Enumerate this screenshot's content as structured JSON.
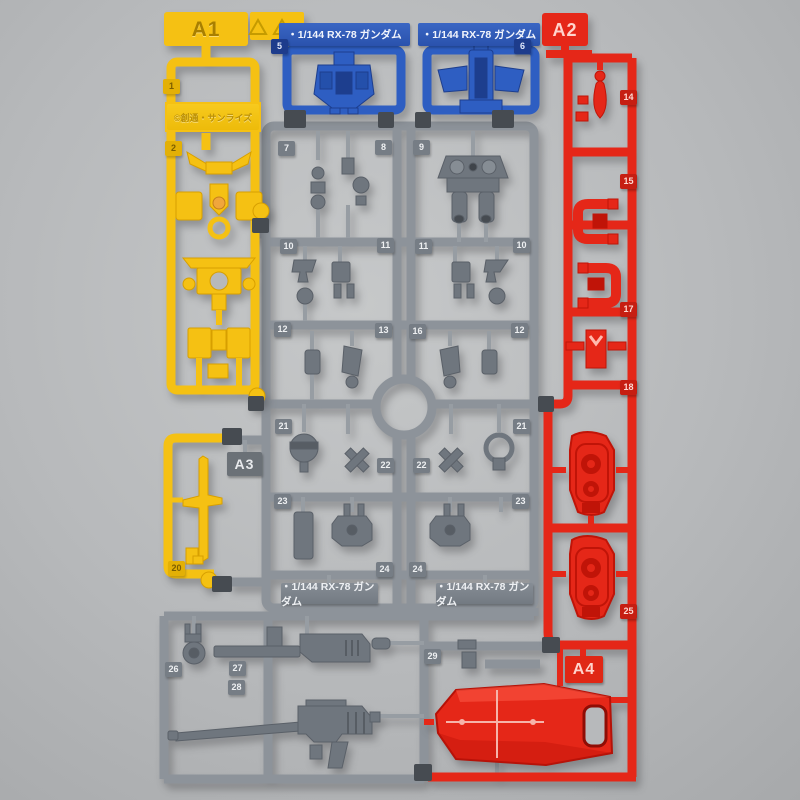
{
  "scene": {
    "subject": "Plastic model kit runner sprue photo — 1/144 RX-78 Gundam, multi-color molded frame",
    "background": "#b7b9ba"
  },
  "colors": {
    "yellow": "#f5c113",
    "blue": "#2e5ec2",
    "red": "#e52718",
    "gray": "#8d939a",
    "dark_joint": "#464b51"
  },
  "gate_labels": {
    "a1": "A1",
    "a2": "A2",
    "a3": "A3",
    "a4": "A4"
  },
  "plates": {
    "blue_left": "・1/144 RX-78 ガンダム",
    "blue_right": "・1/144 RX-78 ガンダム",
    "gray_left": "・1/144 RX-78 ガンダム",
    "gray_right": "・1/144 RX-78 ガンダム",
    "copyright": "©創通・サンライズ"
  },
  "part_numbers": [
    "5",
    "6",
    "7",
    "8",
    "9",
    "10",
    "11",
    "11",
    "10",
    "12",
    "13",
    "16",
    "12",
    "21",
    "22",
    "22",
    "21",
    "23",
    "24",
    "24",
    "23",
    "26",
    "27",
    "28",
    "29",
    "20",
    "1",
    "2",
    "14",
    "15",
    "17",
    "18",
    "25"
  ]
}
